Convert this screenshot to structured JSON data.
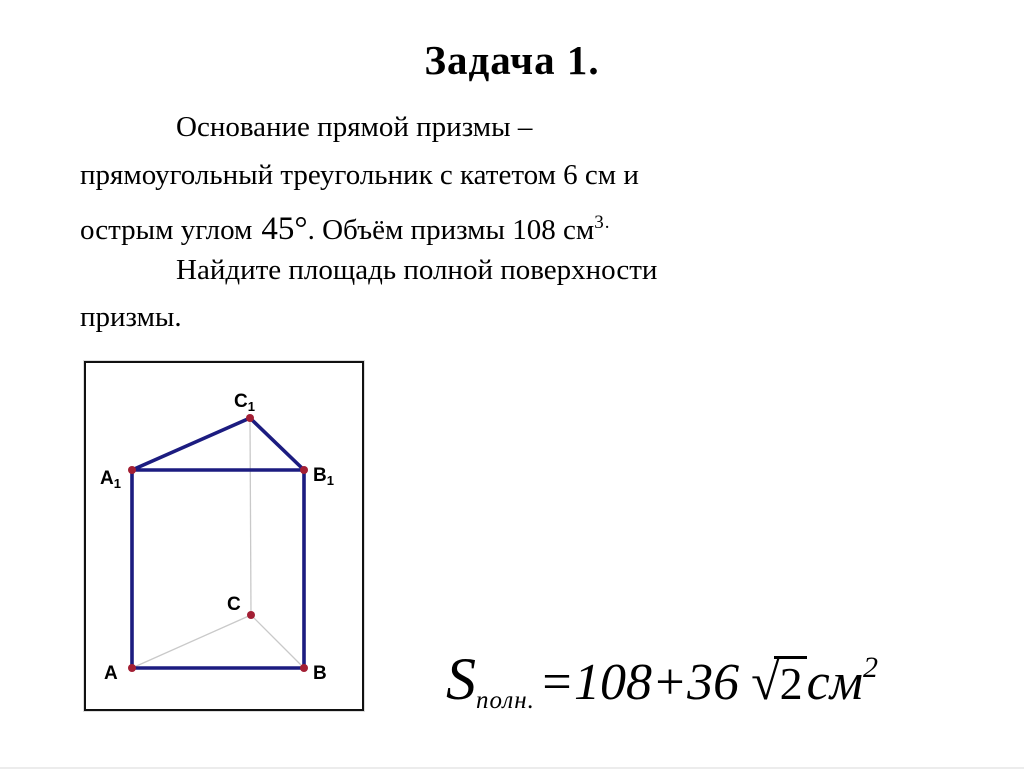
{
  "slide": {
    "title": "Задача 1.",
    "problem": {
      "line1": "Основание прямой призмы –",
      "line2": "прямоугольный треугольник с катетом 6 см и",
      "line3_pre": "острым углом",
      "angle_value": "45",
      "degree_symbol": "°",
      "line3_mid": ". Объём призмы 108 см",
      "volume_exponent": "3.",
      "line4": "Найдите площадь полной поверхности",
      "line5": "призмы."
    }
  },
  "diagram": {
    "type": "right triangular prism ABCA1B1C1",
    "vertex_labels": {
      "A": {
        "main": "A",
        "sub": ""
      },
      "B": {
        "main": "B",
        "sub": ""
      },
      "C": {
        "main": "C",
        "sub": ""
      },
      "A1": {
        "main": "A",
        "sub": "1"
      },
      "B1": {
        "main": "B",
        "sub": "1"
      },
      "C1": {
        "main": "C",
        "sub": "1"
      }
    },
    "colors": {
      "edge": "#1c1c80",
      "hidden_edge": "#c9c9c9",
      "vertex_dot": "#a31f34",
      "border": "#111111"
    }
  },
  "formula": {
    "symbol": "S",
    "subscript": "полн.",
    "expression": "=108+36",
    "radical_sign": "√",
    "radicand": "2",
    "unit": "см",
    "exponent": "2"
  }
}
